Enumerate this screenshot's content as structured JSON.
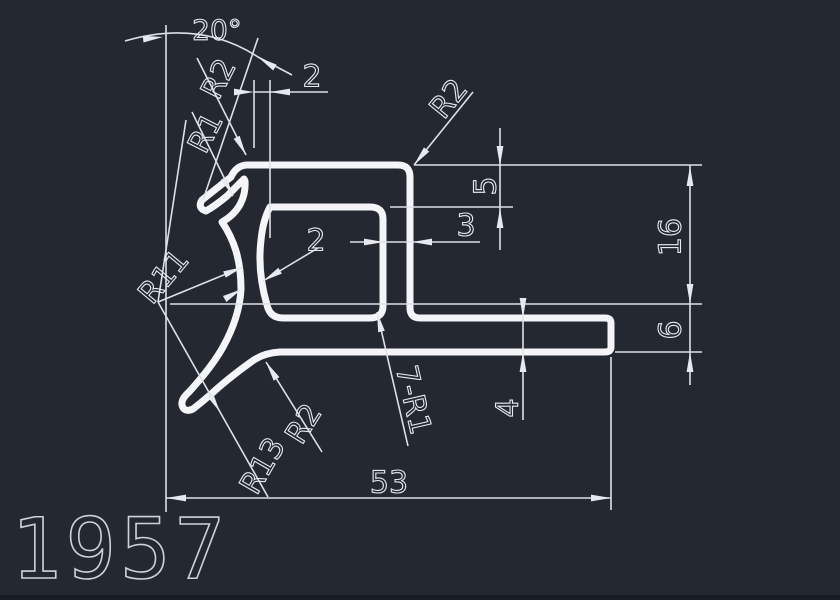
{
  "drawing": {
    "number": "1957",
    "background_color": "#232831",
    "profile_line_color": "#f3f5f8",
    "dimension_line_color": "#dde1e7",
    "dimensions": {
      "angle_top": "20°",
      "lip_offset_top": "2",
      "radius_top_left_outer": "R2",
      "radius_top_left_inner": "R1",
      "radius_top_right_corner": "R2",
      "top_wall_thickness": "5",
      "right_wall_thickness": "3",
      "left_wall_thickness": "2",
      "radius_left_wall": "R11",
      "height_upper_right": "16",
      "height_lower_right": "6",
      "arm_thickness": "4",
      "fillets_note": "7-R1",
      "radius_hook_fillet": "R2",
      "radius_hook_outer": "R13",
      "overall_width": "53"
    }
  }
}
